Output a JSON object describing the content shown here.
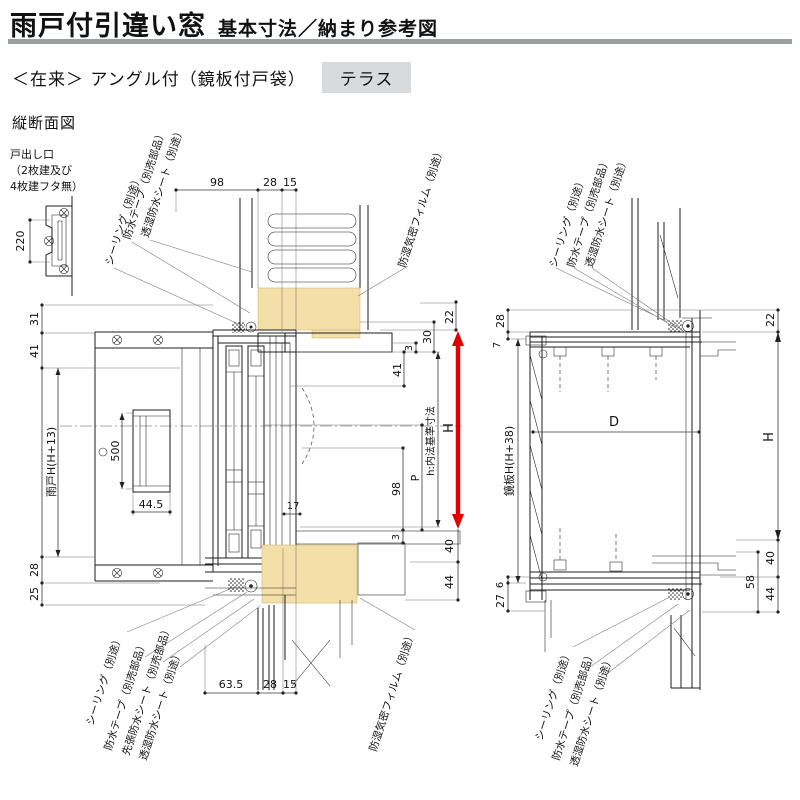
{
  "header": {
    "title": "雨戸付引違い窓",
    "title_suffix": "基本寸法／納まり参考図",
    "spec_line": "＜在来＞ アングル付（鏡板付戸袋）",
    "badge": "テラス",
    "section_label": "縦断面図"
  },
  "colors": {
    "accent_red": "#e00000",
    "wood_fill": "#f3dfa7",
    "rule_gray": "#9b9fa2",
    "badge_bg": "#d9dadb"
  },
  "materials": {
    "sealing": "シーリング（別途）",
    "tape": "防水テープ（別売部品）",
    "pre_sheet": "先張防水シート（別売部品）",
    "sheet": "透湿防水シート（別途）",
    "film": "防湿気密フィルム（別途）"
  },
  "left_view": {
    "note_lines": [
      "戸出し口",
      "（2枚建及び",
      "4枚建フタ無）"
    ],
    "dims": {
      "top_98": "98",
      "top_28": "28",
      "top_15": "15",
      "left_31": "31",
      "left_41": "41",
      "shutter_height": "雨戸H(H+13)",
      "left_28": "28",
      "left_25": "25",
      "handle_220": "220",
      "handle_500": "500",
      "handle_44_5": "44.5",
      "right_22": "22",
      "right_30": "30",
      "right_3_top": "3",
      "right_41": "41",
      "height_h": "H",
      "inner_height": "h:内法基準寸法",
      "p": "P",
      "right_98": "98",
      "offset_17": "17",
      "right_3_bottom": "3",
      "right_40": "40",
      "right_44": "44",
      "bottom_63_5": "63.5",
      "bottom_28": "28",
      "bottom_15": "15"
    }
  },
  "right_view": {
    "dims": {
      "left_28": "28",
      "left_7": "7",
      "panel_height": "鏡板H(H+38)",
      "left_6": "6",
      "left_27": "27",
      "d": "D",
      "right_22": "22",
      "height_h": "H",
      "right_40": "40",
      "right_58": "58",
      "right_44": "44"
    }
  }
}
